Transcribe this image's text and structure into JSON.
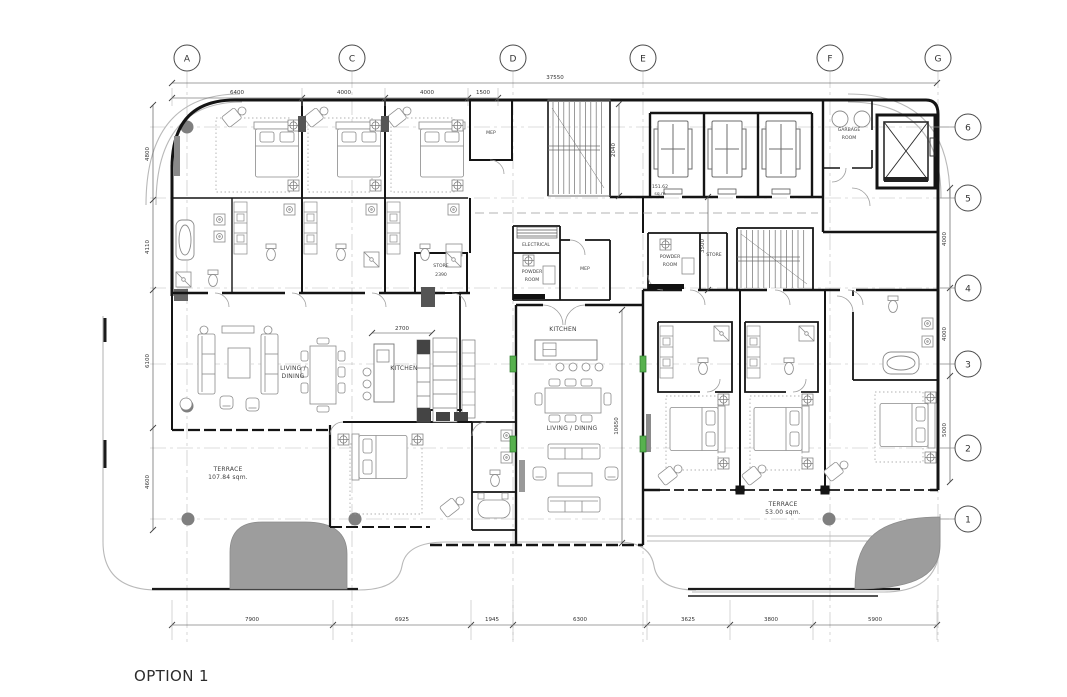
{
  "title": "OPTION 1",
  "grid": {
    "columns": [
      "A",
      "C",
      "D",
      "E",
      "F",
      "G"
    ],
    "rows": [
      "6",
      "5",
      "4",
      "3",
      "2",
      "1"
    ]
  },
  "dims": {
    "overall": "37550",
    "top": [
      "6400",
      "4000",
      "4000",
      "1500"
    ],
    "bottom": [
      "7900",
      "6925",
      "1945",
      "6300",
      "3625",
      "3800",
      "5900"
    ],
    "left": [
      "4800",
      "4110",
      "6100",
      "4600"
    ],
    "right": [
      "4000",
      "4000",
      "5000"
    ],
    "kitchen": "2700",
    "living": "10650",
    "lobby": "3500",
    "stair": "2040"
  },
  "labels": {
    "electrical": "ELECTRICAL",
    "powder1": [
      "POWDER",
      "ROOM"
    ],
    "powder2": [
      "POWDER",
      "ROOM"
    ],
    "mep1": "MEP",
    "mep2": "MEP",
    "store1": [
      "STORE",
      "2390"
    ],
    "store2": "STORE",
    "kitchen1": "KITCHEN",
    "kitchen2": "KITCHEN",
    "living1": [
      "LIVING /",
      "DINING"
    ],
    "living2": "LIVING / DINING",
    "garbage": [
      "GARBAGE",
      "ROOM"
    ],
    "lobby_area": [
      "151.62",
      "sq.m"
    ],
    "terrace1": [
      "TERRACE",
      "107.84 sqm."
    ],
    "terrace2": [
      "TERRACE",
      "53.00 sqm."
    ]
  }
}
